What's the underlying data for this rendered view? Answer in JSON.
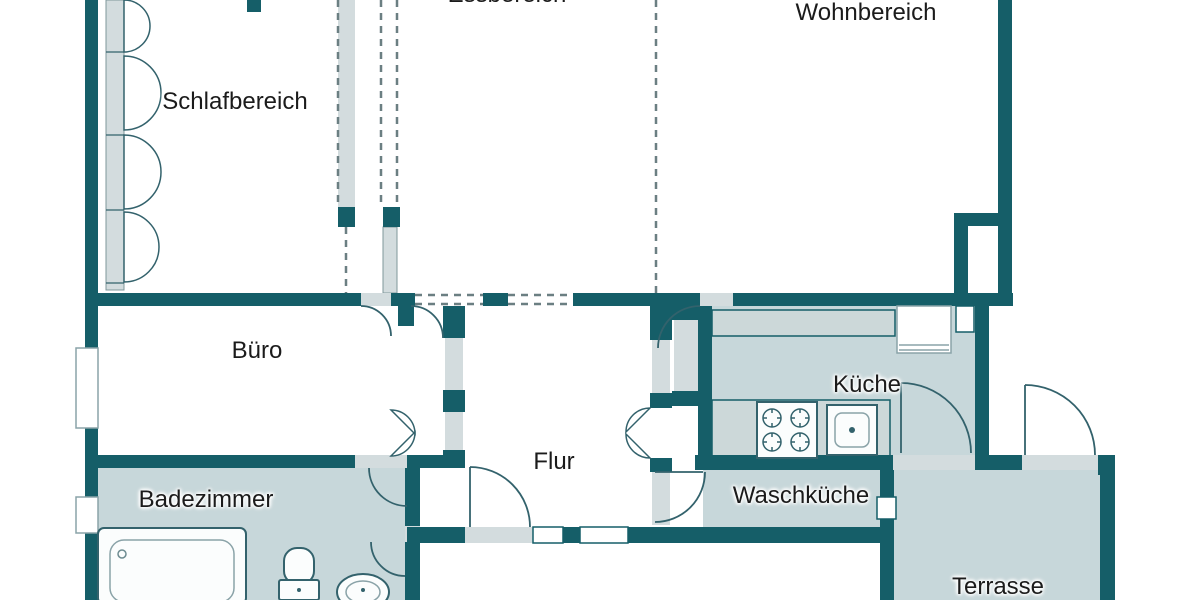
{
  "rooms": {
    "schlafbereich": {
      "label": "Schlafbereich"
    },
    "essbereich": {
      "label": "Essbereich"
    },
    "wohnbereich": {
      "label": "Wohnbereich"
    },
    "buero": {
      "label": "Büro"
    },
    "flur": {
      "label": "Flur"
    },
    "kueche": {
      "label": "Küche"
    },
    "badezimmer": {
      "label": "Badezimmer"
    },
    "waschkueche": {
      "label": "Waschküche"
    },
    "terrasse": {
      "label": "Terrasse"
    }
  },
  "fixtures": [
    "bathtub",
    "toilet",
    "washbasin",
    "stove-4-burner",
    "kitchen-sink",
    "refrigerator",
    "kitchen-counter",
    "casement-windows",
    "door-swings"
  ],
  "colors": {
    "wall": "#155e68",
    "floor_tinted": "#c7d7da",
    "sill": "#d3dcde",
    "counter": "#ccd8d9",
    "stroke": "#33626c",
    "dash": "#6b7f82",
    "label_text": "#1b1b1b"
  }
}
